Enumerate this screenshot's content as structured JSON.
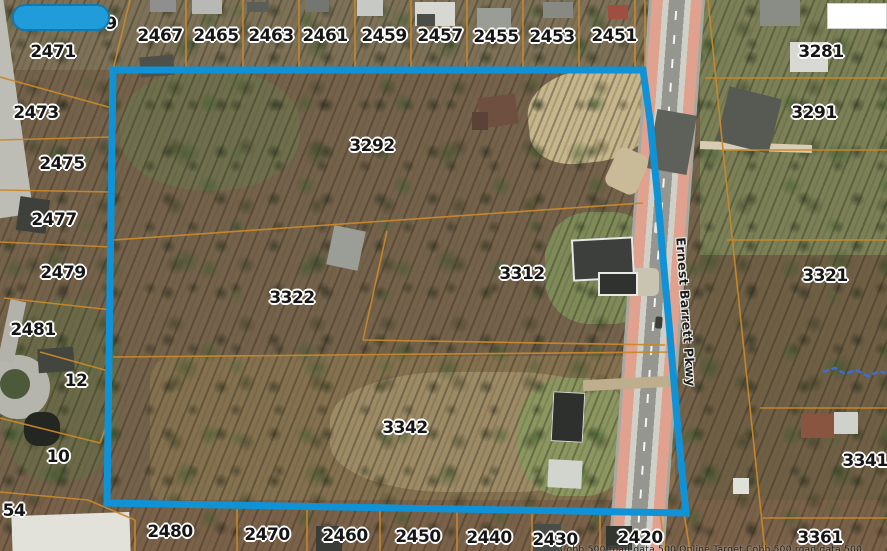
{
  "map": {
    "road_label": "Ernest Barrett Pkwy",
    "attribution": "Cobb 500 road data   500 Online Target Cobb 500 road data   500",
    "colors": {
      "selection": "#0f93d6",
      "parcel_line": "#c8882c",
      "highlight_blob": "#209cdb",
      "road_stripe": "#e0a28f",
      "stream": "#3a6fd8"
    },
    "selected_parcel_ids": [
      "3292",
      "3322",
      "3312",
      "3342"
    ],
    "parcel_labels": [
      {
        "id": "2471",
        "x": 53,
        "y": 52
      },
      {
        "id": "2473",
        "x": 36,
        "y": 113
      },
      {
        "id": "2475",
        "x": 62,
        "y": 164
      },
      {
        "id": "2477",
        "x": 54,
        "y": 220
      },
      {
        "id": "2479",
        "x": 63,
        "y": 273
      },
      {
        "id": "2481",
        "x": 33,
        "y": 330
      },
      {
        "id": "12",
        "x": 76,
        "y": 381
      },
      {
        "id": "10",
        "x": 58,
        "y": 457
      },
      {
        "id": "54",
        "x": 14,
        "y": 511
      },
      {
        "id": "9",
        "x": 111,
        "y": 24
      },
      {
        "id": "2467",
        "x": 160,
        "y": 36
      },
      {
        "id": "2465",
        "x": 216,
        "y": 36
      },
      {
        "id": "2463",
        "x": 271,
        "y": 36
      },
      {
        "id": "2461",
        "x": 325,
        "y": 36
      },
      {
        "id": "2459",
        "x": 384,
        "y": 36
      },
      {
        "id": "2457",
        "x": 440,
        "y": 36
      },
      {
        "id": "2455",
        "x": 496,
        "y": 37
      },
      {
        "id": "2453",
        "x": 552,
        "y": 37
      },
      {
        "id": "2451",
        "x": 614,
        "y": 36
      },
      {
        "id": "3281",
        "x": 821,
        "y": 52
      },
      {
        "id": "3291",
        "x": 814,
        "y": 113
      },
      {
        "id": "3292",
        "x": 372,
        "y": 146
      },
      {
        "id": "3322",
        "x": 292,
        "y": 298
      },
      {
        "id": "3312",
        "x": 522,
        "y": 274
      },
      {
        "id": "3342",
        "x": 405,
        "y": 428
      },
      {
        "id": "3321",
        "x": 825,
        "y": 276
      },
      {
        "id": "3341",
        "x": 865,
        "y": 461
      },
      {
        "id": "2480",
        "x": 170,
        "y": 532
      },
      {
        "id": "2470",
        "x": 267,
        "y": 535
      },
      {
        "id": "2460",
        "x": 345,
        "y": 536
      },
      {
        "id": "2450",
        "x": 418,
        "y": 537
      },
      {
        "id": "2440",
        "x": 489,
        "y": 538
      },
      {
        "id": "2430",
        "x": 555,
        "y": 540
      },
      {
        "id": "2420",
        "x": 640,
        "y": 538
      },
      {
        "id": "3361",
        "x": 820,
        "y": 538
      }
    ]
  }
}
